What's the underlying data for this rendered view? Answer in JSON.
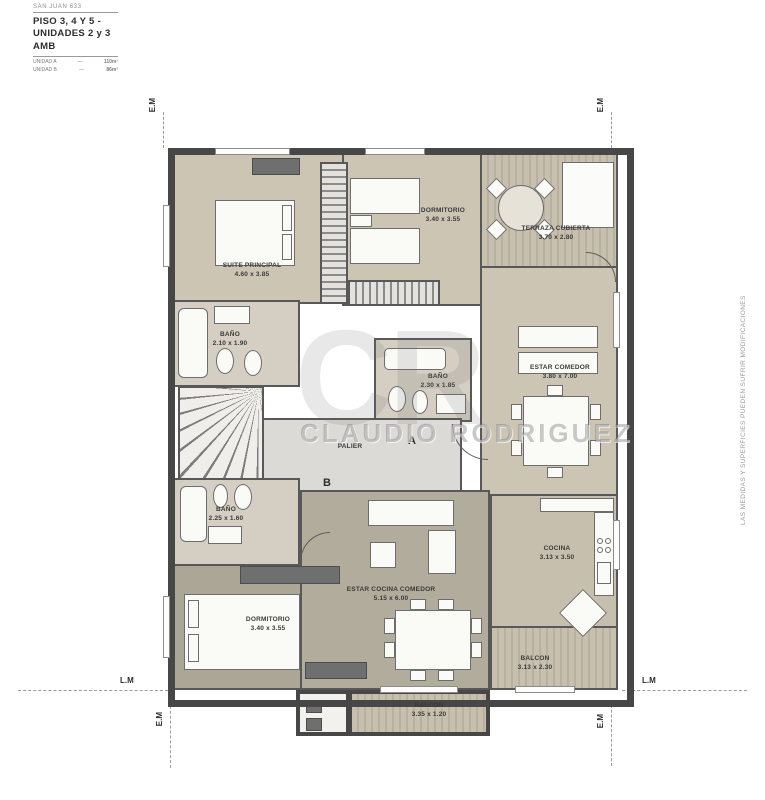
{
  "header": {
    "project": "SAN JUAN 633",
    "title_line1": "PISO 3, 4 Y 5 -",
    "title_line2": "UNIDADES 2 y 3 AMB",
    "units": [
      {
        "name": "UNIDAD A",
        "sep": "—",
        "area": "110m²"
      },
      {
        "name": "UNIDAD B",
        "sep": "—",
        "area": "86m²"
      }
    ]
  },
  "rooms": {
    "suite_principal": {
      "name": "SUITE PRINCIPAL",
      "dims": "4.60 x 3.85"
    },
    "dormitorio_top": {
      "name": "DORMITORIO",
      "dims": "3.40 x 3.55"
    },
    "terraza": {
      "name": "TERRAZA CUBIERTA",
      "dims": "3.70 x 2.80"
    },
    "bano_suite": {
      "name": "BAÑO",
      "dims": "2.10 x 1.90"
    },
    "estar_comedor": {
      "name": "ESTAR COMEDOR",
      "dims": "3.80 x 7.00"
    },
    "bano_central": {
      "name": "BAÑO",
      "dims": "2.30 x 1.85"
    },
    "palier": {
      "name": "PALIER"
    },
    "bano_inferior": {
      "name": "BAÑO",
      "dims": "2.25 x 1.60"
    },
    "dormitorio_bottom": {
      "name": "DORMITORIO",
      "dims": "3.40 x 3.55"
    },
    "estar_cocina_comedor": {
      "name": "ESTAR COCINA COMEDOR",
      "dims": "5.15 x 6.00"
    },
    "cocina": {
      "name": "COCINA",
      "dims": "3.13 x 3.50"
    },
    "balcon_right": {
      "name": "BALCON",
      "dims": "3.13 x 2.30"
    },
    "balcon_bottom": {
      "name": "BALCON",
      "dims": "3.35 x 1.20"
    }
  },
  "unit_markers": {
    "a": "A",
    "b": "B"
  },
  "markers": {
    "em": "E.M",
    "lm": "L.M"
  },
  "watermark": {
    "initials": "CR",
    "name": "CLAUDIO RODRIGUEZ"
  },
  "side_note": "LAS MEDIDAS Y SUPERFICIES PUEDEN SUFRIR MODIFICACIONES",
  "colors": {
    "wall": "#474747",
    "room_beige": "#cdc5b4",
    "room_taupe": "#aca696",
    "palier_gray": "#dbdad6",
    "stripe_light": "#c8c0af",
    "stripe_dark": "#b9b1a0"
  }
}
